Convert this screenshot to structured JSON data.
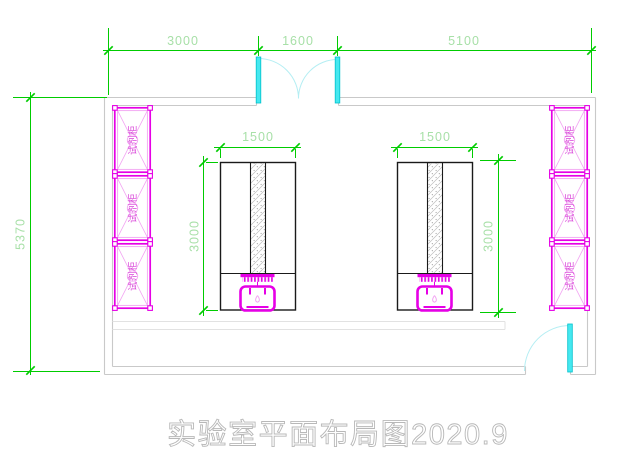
{
  "drawing": {
    "title": "实验室平面布局图2020.9",
    "dimensions": {
      "top_left": "3000",
      "top_middle": "1600",
      "top_right": "5100",
      "room_height": "5370",
      "bench_width_left": "1500",
      "bench_depth_left": "3000",
      "bench_width_right": "1500",
      "bench_depth_right": "3000"
    },
    "cabinets": {
      "label": "试剂柜"
    },
    "colors": {
      "dimension_line": "#00cc00",
      "dimension_text": "#a8e0a8",
      "cabinet": "#e600e6",
      "cabinet_light": "#f2a4f2",
      "cabinet_text": "#d944d9",
      "door": "#45e8f0",
      "door_stroke": "#00c2cc",
      "door_arc": "#b4eef3",
      "wall": "#c9c9c9",
      "bench": "#1a1a1a",
      "title_text": "#b8b8b8"
    }
  }
}
